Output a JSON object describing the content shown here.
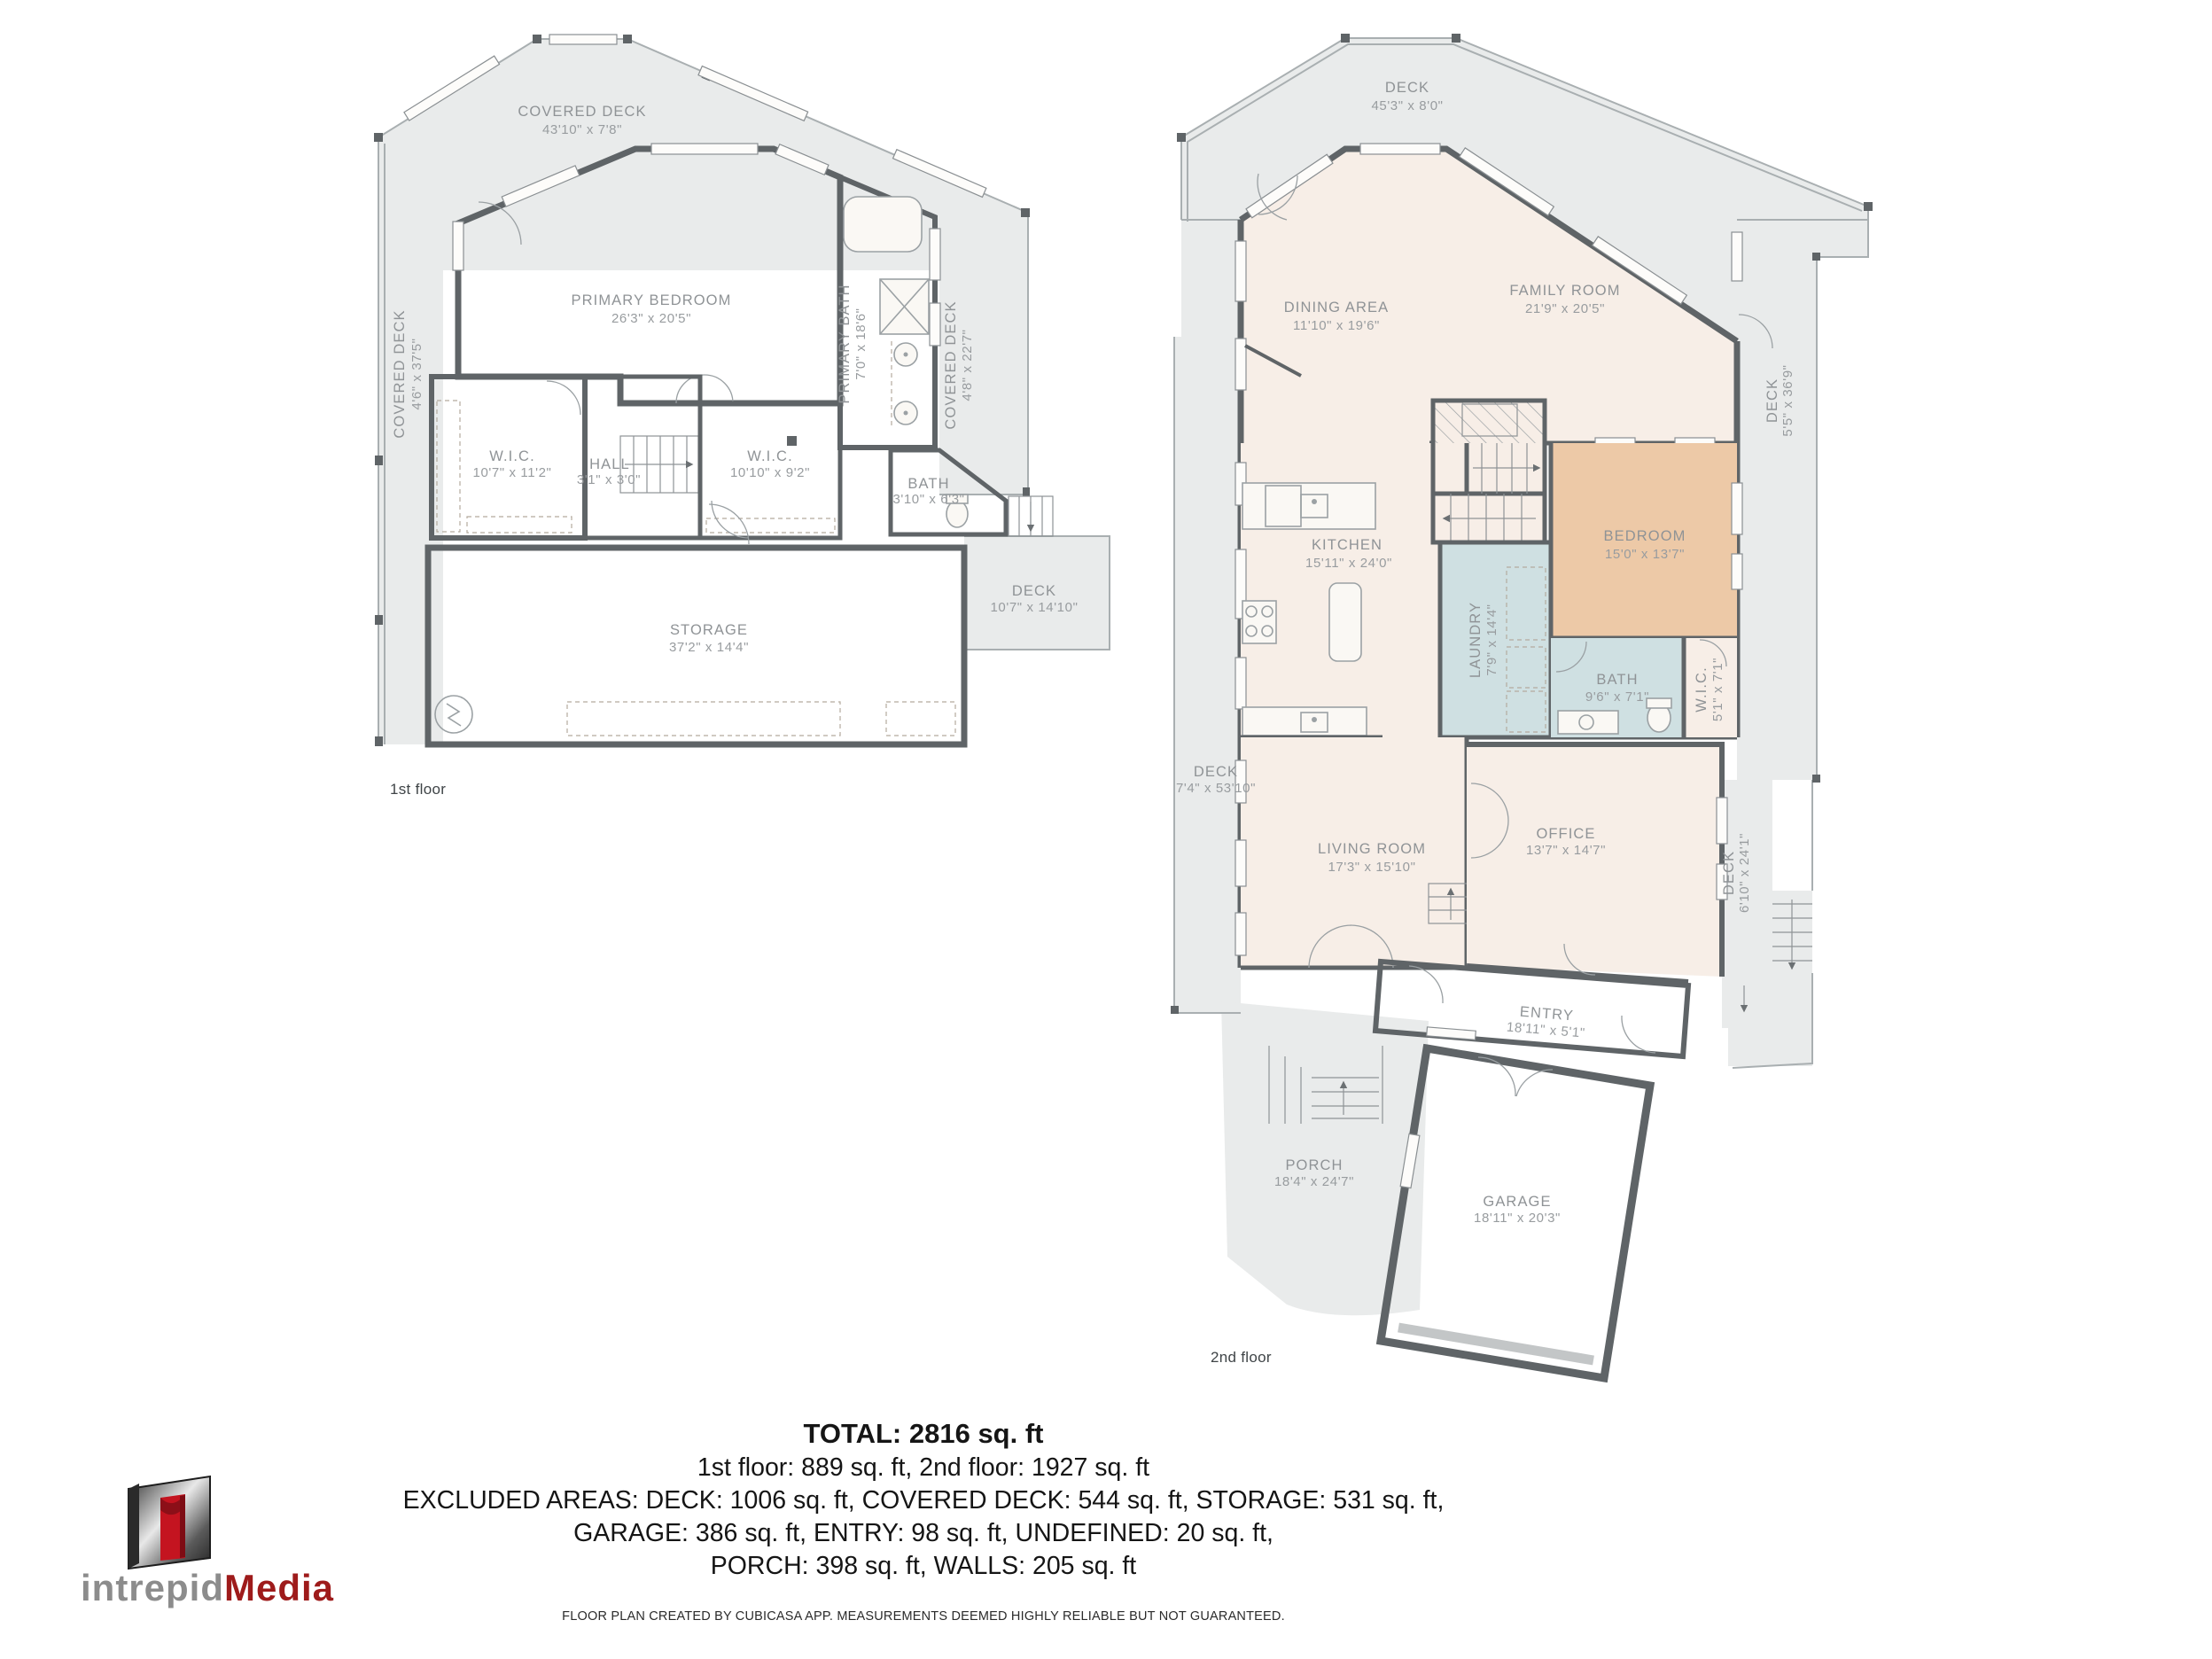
{
  "floor1": {
    "label": "1st floor",
    "covered_deck_top": {
      "name": "COVERED DECK",
      "dims": "43'10\" x 7'8\""
    },
    "covered_deck_left": {
      "name": "COVERED DECK",
      "dims": "4'6\" x 37'5\""
    },
    "covered_deck_right": {
      "name": "COVERED DECK",
      "dims": "4'8\" x 22'7\""
    },
    "primary_bedroom": {
      "name": "PRIMARY BEDROOM",
      "dims": "26'3\" x 20'5\""
    },
    "primary_bath": {
      "name": "PRIMARY BATH",
      "dims": "7'0\" x 18'6\""
    },
    "wic_left": {
      "name": "W.I.C.",
      "dims": "10'7\" x 11'2\""
    },
    "hall": {
      "name": "HALL",
      "dims": "3'1\" x 3'0\""
    },
    "wic_right": {
      "name": "W.I.C.",
      "dims": "10'10\" x 9'2\""
    },
    "bath": {
      "name": "BATH",
      "dims": "3'10\" x 6'3\""
    },
    "storage": {
      "name": "STORAGE",
      "dims": "37'2\" x 14'4\""
    },
    "deck": {
      "name": "DECK",
      "dims": "10'7\" x 14'10\""
    }
  },
  "floor2": {
    "label": "2nd floor",
    "deck_top": {
      "name": "DECK",
      "dims": "45'3\" x 8'0\""
    },
    "dining": {
      "name": "DINING AREA",
      "dims": "11'10\" x 19'6\""
    },
    "family": {
      "name": "FAMILY ROOM",
      "dims": "21'9\" x 20'5\""
    },
    "deck_right": {
      "name": "DECK",
      "dims": "5'5\" x 36'9\""
    },
    "kitchen": {
      "name": "KITCHEN",
      "dims": "15'11\" x 24'0\""
    },
    "laundry": {
      "name": "LAUNDRY",
      "dims": "7'9\" x 14'4\""
    },
    "bedroom": {
      "name": "BEDROOM",
      "dims": "15'0\" x 13'7\""
    },
    "bath": {
      "name": "BATH",
      "dims": "9'6\" x 7'1\""
    },
    "wic": {
      "name": "W.I.C.",
      "dims": "5'1\" x 7'1\""
    },
    "deck_left": {
      "name": "DECK",
      "dims": "7'4\" x 53'10\""
    },
    "living": {
      "name": "LIVING ROOM",
      "dims": "17'3\" x 15'10\""
    },
    "office": {
      "name": "OFFICE",
      "dims": "13'7\" x 14'7\""
    },
    "deck_lower_right": {
      "name": "DECK",
      "dims": "6'10\" x 24'1\""
    },
    "entry": {
      "name": "ENTRY",
      "dims": "18'11\" x 5'1\""
    },
    "porch": {
      "name": "PORCH",
      "dims": "18'4\" x 24'7\""
    },
    "garage": {
      "name": "GARAGE",
      "dims": "18'11\" x 20'3\""
    }
  },
  "summary": {
    "total": "TOTAL: 2816 sq. ft",
    "line1": "1st floor: 889 sq. ft, 2nd floor: 1927 sq. ft",
    "line2": "EXCLUDED AREAS: DECK: 1006 sq. ft, COVERED DECK: 544 sq. ft, STORAGE: 531 sq. ft,",
    "line3": "GARAGE: 386 sq. ft, ENTRY: 98 sq. ft, UNDEFINED: 20 sq. ft,",
    "line4": "PORCH: 398 sq. ft, WALLS: 205 sq. ft",
    "disclaimer": "FLOOR PLAN CREATED BY CUBICASA APP. MEASUREMENTS DEEMED HIGHLY RELIABLE BUT NOT GUARANTEED."
  },
  "logo": {
    "word_gray": "intrepid",
    "word_red": "Media"
  },
  "colors": {
    "deck": "#e9ebeb",
    "interior": "#f7eee7",
    "bedroom": "#edc9a7",
    "bath": "#cfe0e2",
    "wall": "#5f6467",
    "label": "#8f9396",
    "logo_red": "#9e1b1b",
    "logo_gray": "#8c8c8c"
  }
}
